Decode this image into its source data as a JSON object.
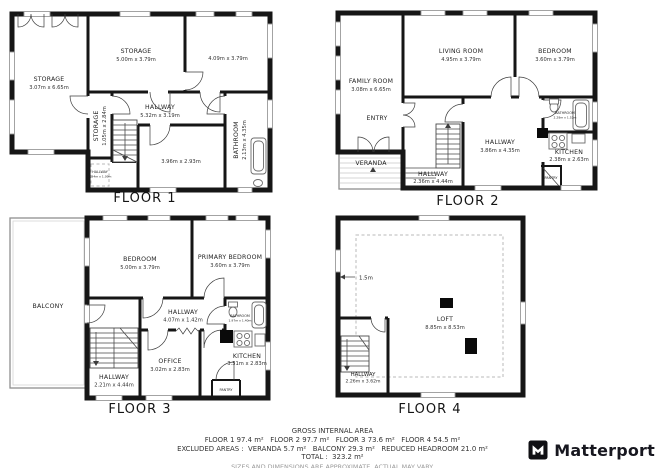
{
  "brand": {
    "name": "Matterport"
  },
  "footer": {
    "heading": "GROSS INTERNAL AREA",
    "floors_line": "FLOOR 1 97.4 m²   FLOOR 2 97.7 m²   FLOOR 3 73.6 m²   FLOOR 4 54.5 m²",
    "excluded_line": "EXCLUDED AREAS :  VERANDA 5.7 m²   BALCONY 29.3 m²   REDUCED HEADROOM 21.0 m²",
    "total_line": "TOTAL :  323.2 m²",
    "disclaimer": "SIZES AND DIMENSIONS ARE APPROXIMATE, ACTUAL MAY VARY."
  },
  "floors": [
    {
      "title": "FLOOR 1",
      "rooms": {
        "storage_left": {
          "name": "STORAGE",
          "dims": "3.07m x 6.65m"
        },
        "storage_top": {
          "name": "STORAGE",
          "dims": "5.00m x 3.79m"
        },
        "room_top_right": {
          "dims": "4.09m x 3.79m"
        },
        "storage_small": {
          "name": "STORAGE",
          "dims": "1.05m x 2.84m"
        },
        "hallway": {
          "name": "HALLWAY",
          "dims": "5.32m x 3.19m"
        },
        "bathroom": {
          "name": "BATHROOM",
          "dims": "2.13m x 4.35m"
        },
        "room_bottom": {
          "dims": "3.96m x 2.93m"
        },
        "closet": {
          "name": "HALLWAY",
          "dims": "0.94m x 1.09m"
        }
      }
    },
    {
      "title": "FLOOR 2",
      "rooms": {
        "family_room": {
          "name": "FAMILY ROOM",
          "dims": "3.08m x 6.65m"
        },
        "living_room": {
          "name": "LIVING ROOM",
          "dims": "4.95m x 3.79m"
        },
        "bedroom": {
          "name": "BEDROOM",
          "dims": "3.60m x 3.79m"
        },
        "entry": {
          "name": "ENTRY"
        },
        "veranda": {
          "name": "VERANDA"
        },
        "hallway_main": {
          "name": "HALLWAY",
          "dims": "3.86m x 4.35m"
        },
        "hallway_stairs": {
          "name": "HALLWAY",
          "dims": "2.36m x 4.44m"
        },
        "kitchen": {
          "name": "KITCHEN",
          "dims": "2.38m x 2.63m"
        },
        "bathroom": {
          "name": "BATHROOM",
          "dims": "2.28m x 1.52m"
        },
        "pantry": {
          "name": "PANTRY"
        }
      }
    },
    {
      "title": "FLOOR 3",
      "rooms": {
        "balcony": {
          "name": "BALCONY"
        },
        "bedroom": {
          "name": "BEDROOM",
          "dims": "5.00m x 3.79m"
        },
        "primary_bedroom": {
          "name": "PRIMARY BEDROOM",
          "dims": "3.60m x 3.79m"
        },
        "hallway_main": {
          "name": "HALLWAY",
          "dims": "4.07m x 1.42m"
        },
        "office": {
          "name": "OFFICE",
          "dims": "3.02m x 2.83m"
        },
        "kitchen": {
          "name": "KITCHEN",
          "dims": "3.31m x 2.83m"
        },
        "bathroom": {
          "name": "BATHROOM",
          "dims": "1.97m x 1.40m"
        },
        "pantry": {
          "name": "PANTRY"
        },
        "hallway_stairs": {
          "name": "HALLWAY",
          "dims": "2.21m x 4.44m"
        }
      }
    },
    {
      "title": "FLOOR 4",
      "rooms": {
        "loft": {
          "name": "LOFT",
          "dims": "8.85m x 8.53m"
        },
        "hallway": {
          "name": "HALLWAY",
          "dims": "2.26m x 3.62m"
        }
      },
      "annotations": {
        "headroom": "1.5m"
      }
    }
  ],
  "colors": {
    "wall": "#161616",
    "label": "#1f1f1f",
    "muted": "#9b9b9b"
  }
}
